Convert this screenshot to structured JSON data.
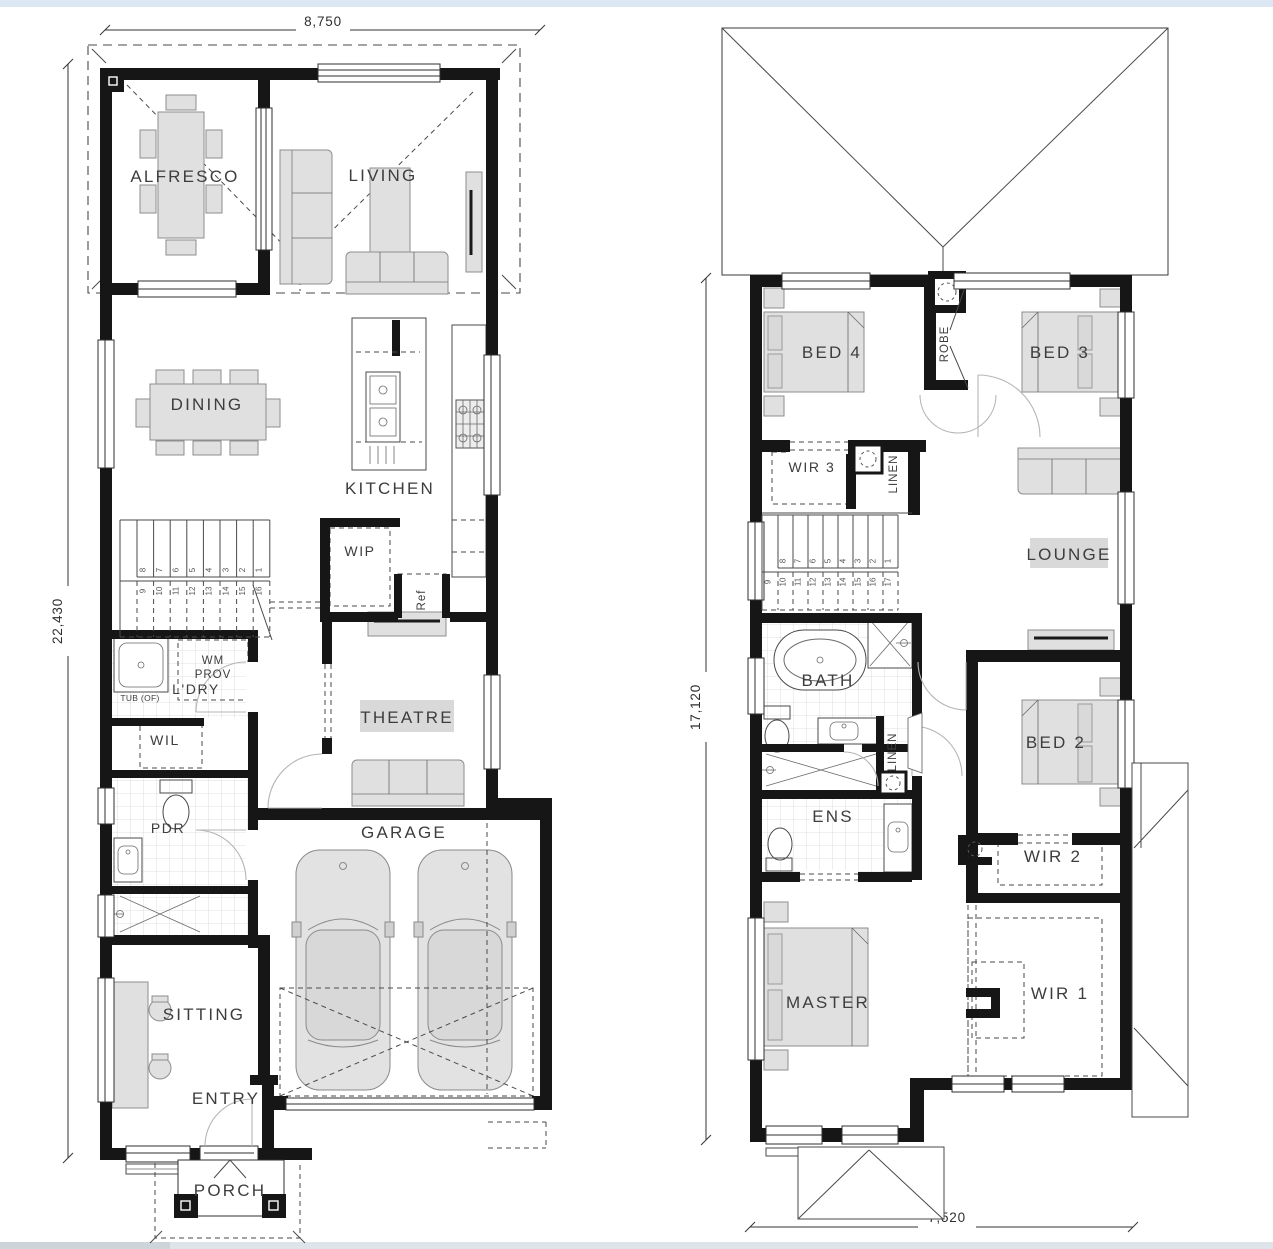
{
  "ground_floor": {
    "dimensions": {
      "top": "8,750",
      "left": "22,430"
    },
    "rooms": {
      "alfresco": "ALFRESCO",
      "living": "LIVING",
      "dining": "DINING",
      "kitchen": "KITCHEN",
      "wip": "WIP",
      "ref": "Ref",
      "laundry": "L'DRY",
      "wm_prov_line1": "WM",
      "wm_prov_line2": "PROV",
      "tub": "TUB (OF)",
      "wil": "WIL",
      "pdr": "PDR",
      "theatre": "THEATRE",
      "garage": "GARAGE",
      "sitting": "SITTING",
      "entry": "ENTRY",
      "porch": "PORCH"
    },
    "stairs": {
      "upper": [
        "8",
        "7",
        "6",
        "5",
        "4",
        "3",
        "2",
        "1"
      ],
      "lower": [
        "9",
        "10",
        "11",
        "12",
        "13",
        "14",
        "15",
        "16"
      ]
    }
  },
  "first_floor": {
    "dimensions": {
      "left": "17,120",
      "bottom": "7,520"
    },
    "rooms": {
      "bed4": "BED 4",
      "robe": "ROBE",
      "bed3": "BED 3",
      "wir3": "WIR 3",
      "linen_upper": "LINEN",
      "lounge": "LOUNGE",
      "bath": "BATH",
      "linen_lower": "LINEN",
      "ens": "ENS",
      "bed2": "BED 2",
      "wir2": "WIR 2",
      "master": "MASTER",
      "wir1": "WIR 1"
    },
    "stairs": {
      "upper": [
        "8",
        "7",
        "6",
        "5",
        "4",
        "3",
        "2",
        "1"
      ],
      "lower": [
        "9",
        "10",
        "11",
        "12",
        "13",
        "14",
        "15",
        "16",
        "17"
      ]
    }
  }
}
